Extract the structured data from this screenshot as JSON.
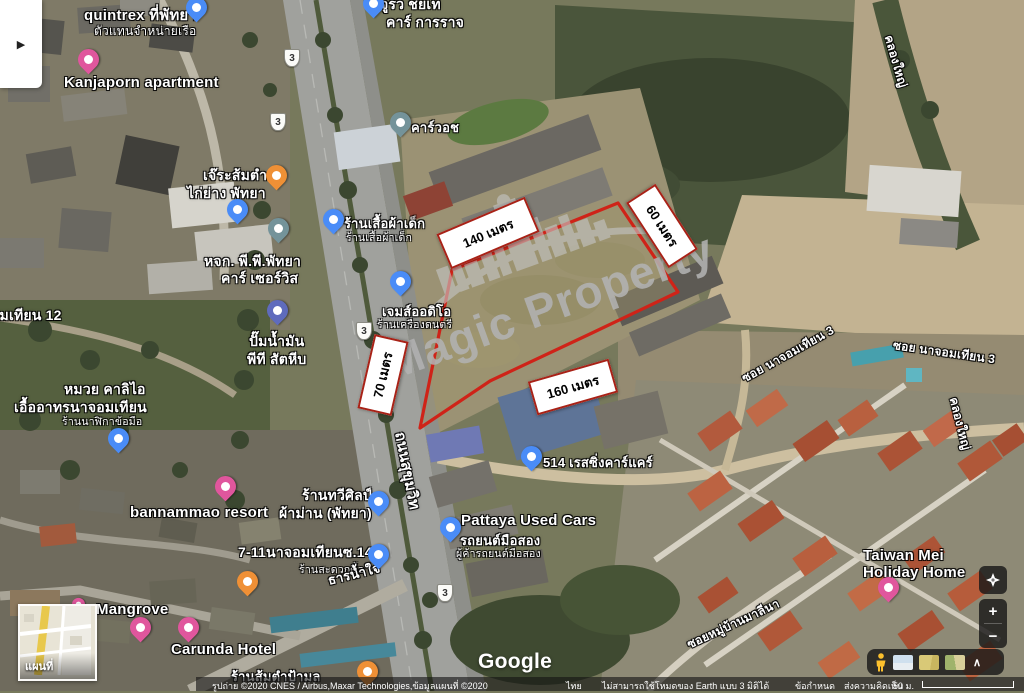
{
  "watermark": {
    "brand": "Magic Property"
  },
  "parcel": {
    "outline_color": "#cf2318",
    "fill_color": "rgba(158,149,108,0.45)",
    "points": "452,270 618,203 678,292 592,333 490,381 420,428",
    "measurements": [
      {
        "label": "140 เมตร",
        "cx": 488,
        "cy": 233,
        "w": 92,
        "h": 34,
        "rot": -23
      },
      {
        "label": "60 เมตร",
        "cx": 662,
        "cy": 226,
        "w": 74,
        "h": 31,
        "rot": 57
      },
      {
        "label": "70 เมตร",
        "cx": 383,
        "cy": 375,
        "w": 72,
        "h": 31,
        "rot": -77
      },
      {
        "label": "160 เมตร",
        "cx": 573,
        "cy": 387,
        "w": 80,
        "h": 31,
        "rot": -16
      }
    ]
  },
  "map": {
    "route_shield": "3",
    "shields": [
      {
        "x": 291,
        "y": 57
      },
      {
        "x": 277,
        "y": 121
      },
      {
        "x": 363,
        "y": 330
      },
      {
        "x": 444,
        "y": 592
      }
    ],
    "labels": [
      {
        "text": "quintrex ที่พัทยา",
        "x": 84,
        "y": 3,
        "size": 15,
        "type": "poi"
      },
      {
        "text": "ตัวแทนจำหน่ายเรือ",
        "x": 94,
        "y": 22,
        "size": 12,
        "type": "poi-sub"
      },
      {
        "text": "จูรว ชยเท",
        "x": 380,
        "y": -6,
        "size": 14,
        "type": "poi"
      },
      {
        "text": "คาร์ การราจ",
        "x": 386,
        "y": 12,
        "size": 14,
        "type": "poi"
      },
      {
        "text": "Kanjaporn apartment",
        "x": 64,
        "y": 74,
        "size": 15,
        "type": "poi"
      },
      {
        "text": "เจ๊ระส้มตำ",
        "x": 203,
        "y": 165,
        "size": 14,
        "type": "poi"
      },
      {
        "text": "ไก่ย่าง พัทยา",
        "x": 187,
        "y": 183,
        "size": 14,
        "type": "poi"
      },
      {
        "text": "คาร์วอช",
        "x": 411,
        "y": 117,
        "size": 13,
        "type": "poi"
      },
      {
        "text": "ร้านเสื้อผ้าเด็ก",
        "x": 344,
        "y": 213,
        "size": 13,
        "type": "poi"
      },
      {
        "text": "ร้านเสื้อผ้าเด็ก",
        "x": 346,
        "y": 229,
        "size": 10.5,
        "type": "poi-sub"
      },
      {
        "text": "หจก. พี.พี.พัทยา",
        "x": 204,
        "y": 251,
        "size": 14,
        "type": "poi"
      },
      {
        "text": "คาร์ เซอร์วิส",
        "x": 221,
        "y": 268,
        "size": 14,
        "type": "poi"
      },
      {
        "text": "เจมส์ออดิโอ",
        "x": 382,
        "y": 301,
        "size": 13,
        "type": "poi"
      },
      {
        "text": "ร้านเครื่องดนตรี",
        "x": 377,
        "y": 316,
        "size": 10.5,
        "type": "poi-sub"
      },
      {
        "text": "ปั๊มน้ำมัน",
        "x": 249,
        "y": 331,
        "size": 14,
        "type": "poi"
      },
      {
        "text": "พีที สัตหีบ",
        "x": 247,
        "y": 349,
        "size": 14,
        "type": "poi"
      },
      {
        "text": "ซอยนาจอมเทียน 12",
        "x": -62,
        "y": 305,
        "size": 14,
        "type": "road"
      },
      {
        "text": "หมวย คาลิไอ",
        "x": 64,
        "y": 379,
        "size": 14,
        "type": "poi"
      },
      {
        "text": "เอื้ออาทรนาจอมเทียน",
        "x": 14,
        "y": 397,
        "size": 14,
        "type": "poi"
      },
      {
        "text": "ร้านนาฬิกาข้อมือ",
        "x": 62,
        "y": 413,
        "size": 10.5,
        "type": "poi-sub"
      },
      {
        "text": "bannammao resort",
        "x": 130,
        "y": 504,
        "size": 15,
        "type": "poi"
      },
      {
        "text": "ร้านทวีศิลป์",
        "x": 302,
        "y": 485,
        "size": 14,
        "type": "poi"
      },
      {
        "text": "ผ้าม่าน (พัทยา)",
        "x": 279,
        "y": 503,
        "size": 14,
        "type": "poi"
      },
      {
        "text": "7-11นาจอมเทียนซ.14",
        "x": 238,
        "y": 542,
        "size": 14,
        "type": "poi"
      },
      {
        "text": "ร้านสะดวกซื้อ",
        "x": 299,
        "y": 561,
        "size": 10.5,
        "type": "poi-sub"
      },
      {
        "text": "ธารน้ำใจ",
        "x": 328,
        "y": 570,
        "size": 13,
        "rot": -14,
        "type": "road"
      },
      {
        "text": "Mangrove",
        "x": 96,
        "y": 601,
        "size": 15,
        "type": "poi"
      },
      {
        "text": "Carunda Hotel",
        "x": 171,
        "y": 641,
        "size": 15,
        "type": "poi"
      },
      {
        "text": "ร้านส้มตำป้ามล",
        "x": 231,
        "y": 666,
        "size": 13,
        "type": "poi"
      },
      {
        "text": "514 เรสซิ่งคาร์แคร์",
        "x": 543,
        "y": 452,
        "size": 13,
        "type": "poi"
      },
      {
        "text": "Pattaya Used Cars",
        "x": 461,
        "y": 512,
        "size": 15,
        "type": "poi"
      },
      {
        "text": "รถยนต์มือสอง",
        "x": 460,
        "y": 530,
        "size": 13,
        "type": "poi"
      },
      {
        "text": "ผู้ค้ารถยนต์มือสอง",
        "x": 456,
        "y": 545,
        "size": 10.5,
        "type": "poi-sub"
      },
      {
        "text": "Taiwan Mei",
        "x": 863,
        "y": 547,
        "size": 15,
        "type": "poi"
      },
      {
        "text": "Holiday Home",
        "x": 863,
        "y": 564,
        "size": 15,
        "type": "poi"
      },
      {
        "text": "ซอย นาจอมเทียน 3",
        "x": 743,
        "y": 370,
        "size": 12,
        "rot": -29,
        "type": "road"
      },
      {
        "text": "ซอย นาจอมเทียน 3",
        "x": 893,
        "y": 336,
        "size": 12,
        "rot": 8,
        "type": "road"
      },
      {
        "text": "คลองใหญ่",
        "x": 888,
        "y": 26,
        "size": 12,
        "rot": 74,
        "type": "road"
      },
      {
        "text": "คลองใหญ่",
        "x": 953,
        "y": 388,
        "size": 12,
        "rot": 76,
        "type": "road"
      },
      {
        "text": "ถนนสุขุมวิท",
        "x": 400,
        "y": 420,
        "size": 15,
        "rot": 79,
        "type": "road"
      },
      {
        "text": "ซอยหมู่บ้านมาลีนา",
        "x": 688,
        "y": 636,
        "size": 12,
        "rot": -25,
        "type": "road"
      }
    ],
    "pins": [
      {
        "kind": "place",
        "color": "#4a8cf7",
        "x": 196,
        "y": 22
      },
      {
        "kind": "lodging",
        "color": "#e0569d",
        "x": 88,
        "y": 74
      },
      {
        "kind": "place",
        "color": "#4a8cf7",
        "x": 373,
        "y": 18
      },
      {
        "kind": "restaurant",
        "color": "#ef9036",
        "x": 276,
        "y": 190
      },
      {
        "kind": "shopping",
        "color": "#4a8cf7",
        "x": 237,
        "y": 224
      },
      {
        "kind": "generic",
        "color": "#74939a",
        "x": 278,
        "y": 243
      },
      {
        "kind": "shopping",
        "color": "#4a8cf7",
        "x": 333,
        "y": 234
      },
      {
        "kind": "generic",
        "color": "#74939a",
        "x": 400,
        "y": 137
      },
      {
        "kind": "shopping",
        "color": "#4a8cf7",
        "x": 400,
        "y": 296
      },
      {
        "kind": "gas-station",
        "color": "#5f6bbd",
        "x": 277,
        "y": 325
      },
      {
        "kind": "shopping",
        "color": "#4a8cf7",
        "x": 118,
        "y": 453
      },
      {
        "kind": "place",
        "color": "#4a8cf7",
        "x": 531,
        "y": 471
      },
      {
        "kind": "shopping",
        "color": "#4a8cf7",
        "x": 450,
        "y": 542
      },
      {
        "kind": "shopping",
        "color": "#4a8cf7",
        "x": 378,
        "y": 516
      },
      {
        "kind": "convenience-store",
        "color": "#4a8cf7",
        "x": 378,
        "y": 569
      },
      {
        "kind": "lodging",
        "color": "#e0569d",
        "x": 225,
        "y": 501
      },
      {
        "kind": "restaurant",
        "color": "#ef9036",
        "x": 247,
        "y": 596
      },
      {
        "kind": "lodging",
        "color": "#e0569d",
        "x": 78,
        "y": 613,
        "small": true
      },
      {
        "kind": "lodging",
        "color": "#e0569d",
        "x": 140,
        "y": 642
      },
      {
        "kind": "lodging",
        "color": "#e0569d",
        "x": 188,
        "y": 642
      },
      {
        "kind": "restaurant",
        "color": "#ef9036",
        "x": 367,
        "y": 686
      },
      {
        "kind": "lodging",
        "color": "#e0569d",
        "x": 888,
        "y": 602
      }
    ]
  },
  "inset_map": {
    "label": "แผนที่"
  },
  "side_panel": {
    "toggle_icon": "▶"
  },
  "controls": {
    "zoom_in": "+",
    "zoom_out": "−",
    "layers_collapse": "∧"
  },
  "google_logo": "Google",
  "footer": {
    "imagery_attribution": "รูปถ่าย ©2020 CNES / Airbus,Maxar Technologies,ข้อมูลแผนที่ ©2020",
    "region": "ไทย",
    "notice": "ไม่สามารถใช้โหมดของ Earth แบบ 3 มิติได้",
    "terms": "ข้อกำหนด",
    "feedback": "ส่งความคิดเห็น",
    "scale": "50 ม."
  }
}
